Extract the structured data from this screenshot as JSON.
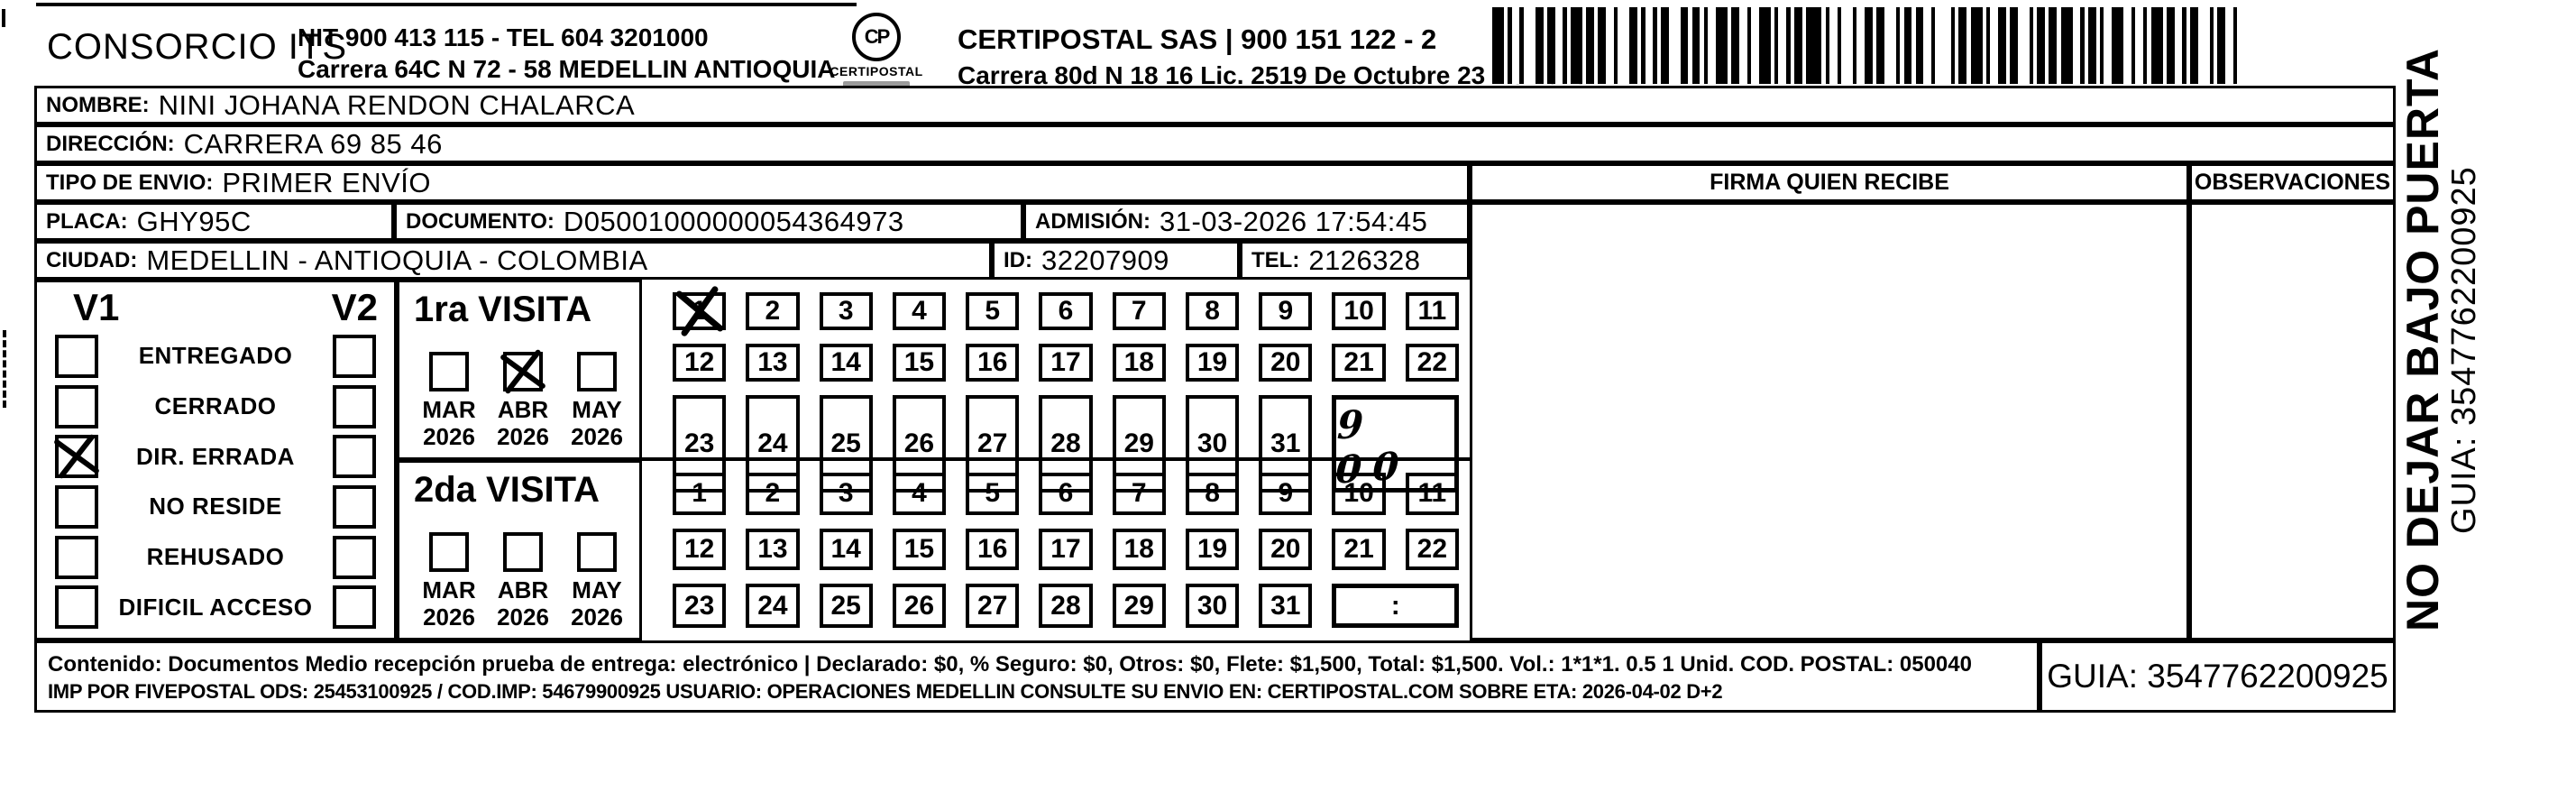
{
  "header": {
    "company": "CONSORCIO ITS",
    "company_info_line1": "NIT 900 413 115 - TEL 604 3201000",
    "company_info_line2": "Carrera 64C N 72 - 58 MEDELLIN ANTIOQUIA",
    "logo_monogram": "CP",
    "logo_label": "CERTIPOSTAL",
    "postal_name": "CERTIPOSTAL SAS | 900 151 122 - 2",
    "postal_info": "Carrera 80d N 18 16  Lic. 2519 De Octubre 23 De 2015",
    "barcode_pattern": "311213212211312122132112112321211231221231121121411213122123112122141121311221231121213211211232121131221123112212"
  },
  "recipient": {
    "nombre_label": "NOMBRE:",
    "nombre": "NINI JOHANA RENDON CHALARCA",
    "direccion_label": "DIRECCIÓN:",
    "direccion": "CARRERA 69 85 46",
    "tipo_envio_label": "TIPO DE ENVIO:",
    "tipo_envio": "PRIMER ENVÍO",
    "placa_label": "PLACA:",
    "placa": "GHY95C",
    "documento_label": "DOCUMENTO:",
    "documento": "D05001000000054364973",
    "admision_label": "ADMISIÓN:",
    "admision": "31-03-2026 17:54:45",
    "ciudad_label": "CIUDAD:",
    "ciudad": "MEDELLIN - ANTIOQUIA - COLOMBIA",
    "id_label": "ID:",
    "id": "32207909",
    "tel_label": "TEL:",
    "tel": "2126328"
  },
  "columns": {
    "firma": "FIRMA QUIEN RECIBE",
    "observaciones": "OBSERVACIONES"
  },
  "status": {
    "v1_header": "V1",
    "v2_header": "V2",
    "rows": [
      {
        "label": "ENTREGADO",
        "v1": false,
        "v2": false
      },
      {
        "label": "CERRADO",
        "v1": false,
        "v2": false
      },
      {
        "label": "DIR. ERRADA",
        "v1": true,
        "v2": false
      },
      {
        "label": "NO RESIDE",
        "v1": false,
        "v2": false
      },
      {
        "label": "REHUSADO",
        "v1": false,
        "v2": false
      },
      {
        "label": "DIFICIL ACCESO",
        "v1": false,
        "v2": false
      }
    ]
  },
  "days": [
    "1",
    "2",
    "3",
    "4",
    "5",
    "6",
    "7",
    "8",
    "9",
    "10",
    "11",
    "12",
    "13",
    "14",
    "15",
    "16",
    "17",
    "18",
    "19",
    "20",
    "21",
    "22",
    "23",
    "24",
    "25",
    "26",
    "27",
    "28",
    "29",
    "30",
    "31"
  ],
  "visita1": {
    "title": "1ra VISITA",
    "months": [
      {
        "month": "MAR",
        "year": "2026",
        "checked": false
      },
      {
        "month": "ABR",
        "year": "2026",
        "checked": true
      },
      {
        "month": "MAY",
        "year": "2026",
        "checked": false
      }
    ],
    "days_marked": [
      1
    ],
    "time": "9 00",
    "time_handwritten": true
  },
  "visita2": {
    "title": "2da VISITA",
    "months": [
      {
        "month": "MAR",
        "year": "2026",
        "checked": false
      },
      {
        "month": "ABR",
        "year": "2026",
        "checked": false
      },
      {
        "month": "MAY",
        "year": "2026",
        "checked": false
      }
    ],
    "days_marked": [],
    "time": ":",
    "time_handwritten": false
  },
  "footer": {
    "line1": "Contenido: Documentos Medio recepción prueba de entrega: electrónico | Declarado: $0, % Seguro: $0, Otros: $0, Flete: $1,500, Total: $1,500. Vol.: 1*1*1. 0.5  1 Unid. COD. POSTAL: 050040",
    "line2": "IMP POR FIVEPOSTAL ODS: 25453100925 / COD.IMP: 54679900925 USUARIO: OPERACIONES MEDELLIN CONSULTE SU ENVIO EN: CERTIPOSTAL.COM SOBRE ETA: 2026-04-02 D+2",
    "guia": "GUIA: 3547762200925"
  },
  "side": {
    "warning": "NO DEJAR BAJO PUERTA",
    "guia": "GUIA: 3547762200925"
  }
}
